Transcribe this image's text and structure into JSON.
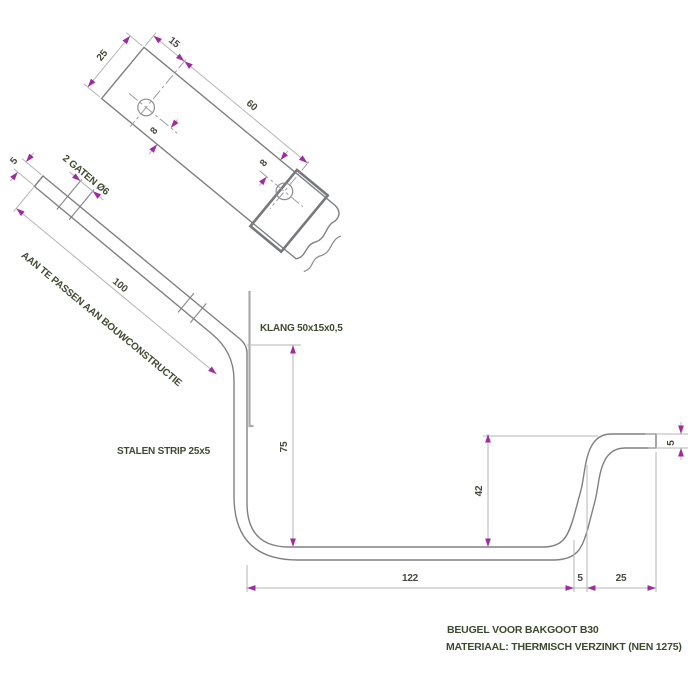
{
  "drawing": {
    "title": "BEUGEL VOOR BAKGOOT B30",
    "material_note": "MATERIAAL: THERMISCH VERZINKT (NEN 1275)",
    "labels": {
      "klang": "KLANG 50x15x0,5",
      "steel_strip": "STALEN STRIP 25x5",
      "fit_note": "AAN TE PASSEN AAN BOUWCONSTRUCTIE",
      "holes": "2 GATEN Ø6"
    },
    "dims": {
      "face_width": "25",
      "face_end_to_hole": "15",
      "face_hole_spacing": "60",
      "face_hole1_edge": "8",
      "face_hole2_edge": "8",
      "edge_thickness": "5",
      "edge_length": "100",
      "profile_drop": "75",
      "profile_rise": "42",
      "profile_bottom": "122",
      "profile_offset": "5",
      "profile_lip": "25",
      "profile_lip_thickness": "5"
    },
    "colors": {
      "background": "#ffffff",
      "object_line": "#7e8083",
      "dimension_line": "#b3b5b8",
      "arrow": "#a02b9e",
      "label_text": "#404a31",
      "number_text": "#4a493e"
    }
  }
}
